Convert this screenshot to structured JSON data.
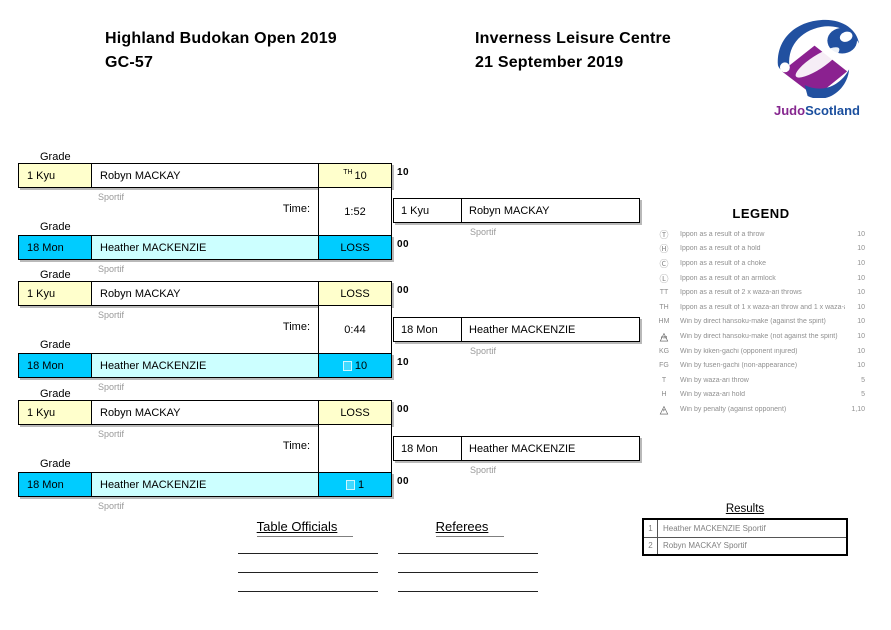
{
  "header": {
    "title": "Highland Budokan Open 2019",
    "category": "GC-57",
    "venue": "Inverness Leisure Centre",
    "date": "21 September 2019"
  },
  "logo": {
    "judo": "Judo",
    "scotland": "Scotland",
    "purple": "#86278f",
    "blue": "#1b4f9e"
  },
  "labels": {
    "grade": "Grade",
    "time": "Time:"
  },
  "colors": {
    "grade_yellow": "#ffffcc",
    "grade_cyan": "#00ccff",
    "name_pale_cyan": "#ccffff"
  },
  "matches": [
    {
      "p1": {
        "grade": "1 Kyu",
        "name": "Robyn MACKAY",
        "club": "Sportif",
        "score_code": "TH",
        "score": "10",
        "points": "10"
      },
      "time": "1:52",
      "p2": {
        "grade": "18 Mon",
        "name": "Heather MACKENZIE",
        "club": "Sportif",
        "score_code": "",
        "score": "LOSS",
        "points": "00"
      },
      "winner": {
        "grade": "1 Kyu",
        "name": "Robyn MACKAY",
        "club": "Sportif"
      }
    },
    {
      "p1": {
        "grade": "1 Kyu",
        "name": "Robyn MACKAY",
        "club": "Sportif",
        "score_code": "",
        "score": "LOSS",
        "points": "00"
      },
      "time": "0:44",
      "p2": {
        "grade": "18 Mon",
        "name": "Heather MACKENZIE",
        "club": "Sportif",
        "score_code": "",
        "score": "10",
        "points": "10"
      },
      "winner": {
        "grade": "18 Mon",
        "name": "Heather MACKENZIE",
        "club": "Sportif"
      }
    },
    {
      "p1": {
        "grade": "1 Kyu",
        "name": "Robyn MACKAY",
        "club": "Sportif",
        "score_code": "",
        "score": "LOSS",
        "points": "00"
      },
      "time": "",
      "p2": {
        "grade": "18 Mon",
        "name": "Heather MACKENZIE",
        "club": "Sportif",
        "score_code": "",
        "score": "1",
        "points": "00"
      },
      "winner": {
        "grade": "18 Mon",
        "name": "Heather MACKENZIE",
        "club": "Sportif"
      }
    }
  ],
  "legend": {
    "title": "LEGEND",
    "items": [
      {
        "symbol": "Ⓣ",
        "sub": "",
        "text": "Ippon as a result of a throw",
        "value": "10"
      },
      {
        "symbol": "Ⓗ",
        "sub": "",
        "text": "Ippon as a result of a hold",
        "value": "10"
      },
      {
        "symbol": "Ⓒ",
        "sub": "",
        "text": "Ippon as a result of a choke",
        "value": "10"
      },
      {
        "symbol": "Ⓛ",
        "sub": "",
        "text": "Ippon as a result of an armlock",
        "value": "10"
      },
      {
        "symbol": "TT",
        "sub": "",
        "text": "Ippon as a result of 2 x waza-ari throws",
        "value": "10"
      },
      {
        "symbol": "TH",
        "sub": "",
        "text": "Ippon as a result of 1 x waza-ari throw and 1 x waza-ari hold",
        "value": "10"
      },
      {
        "symbol": "HM",
        "sub": "",
        "text": "Win by direct hansoku-make (against the spirit)",
        "value": "10"
      },
      {
        "symbol": "△",
        "sub": "HM",
        "text": "Win by direct hansoku-make (not against the spirit)",
        "value": "10"
      },
      {
        "symbol": "KG",
        "sub": "",
        "text": "Win by kiken-gachi (opponent injured)",
        "value": "10"
      },
      {
        "symbol": "FG",
        "sub": "",
        "text": "Win by fusen-gachi (non-appearance)",
        "value": "10"
      },
      {
        "symbol": "T",
        "sub": "",
        "text": "Win by waza-ari throw",
        "value": "5"
      },
      {
        "symbol": "H",
        "sub": "",
        "text": "Win by waza-ari hold",
        "value": "5"
      },
      {
        "symbol": "△",
        "sub": "P",
        "text": "Win by penalty (against opponent)",
        "value": "1,10"
      }
    ]
  },
  "results": {
    "title": "Results",
    "rows": [
      {
        "rank": "1",
        "name": "Heather MACKENZIE Sportif"
      },
      {
        "rank": "2",
        "name": "Robyn MACKAY Sportif"
      }
    ]
  },
  "officials": {
    "table_officials": "Table Officials",
    "referees": "Referees"
  }
}
